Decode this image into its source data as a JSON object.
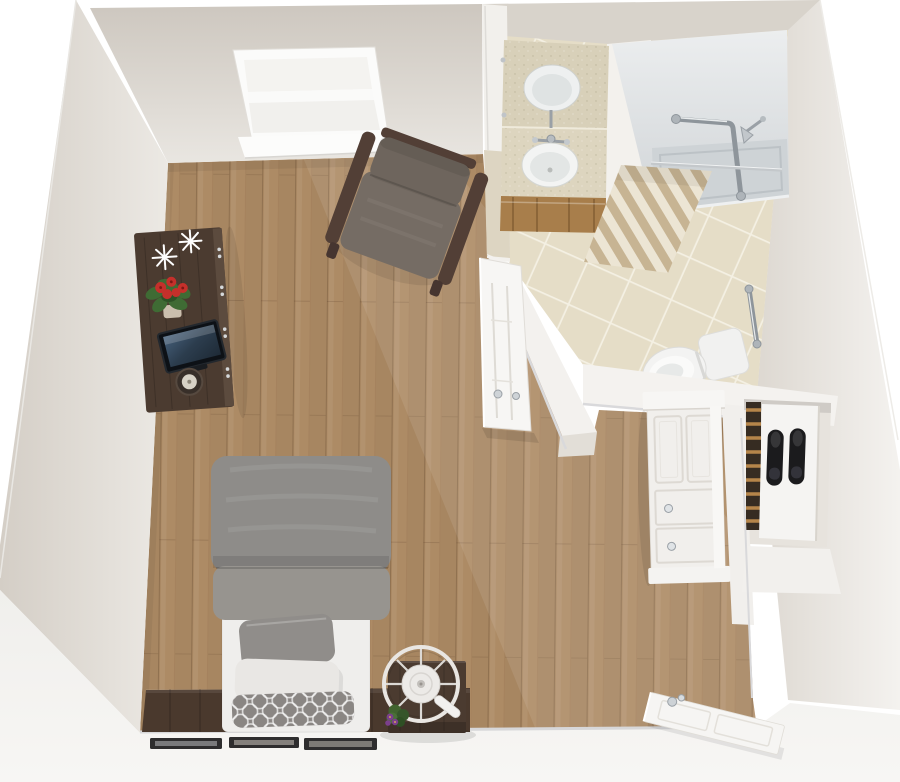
{
  "meta": {
    "title": "Studio apartment with accessible bathroom - top-down 3D floor plan render",
    "view": "top-down dollhouse 3D render",
    "canvas_width": 900,
    "canvas_height": 782
  },
  "colors": {
    "background": "#ffffff",
    "wall_top": "#f4f2ef",
    "wall_face": "#d9d4cc",
    "baseboard": "#d7d7d9",
    "floor_wood": "#ad8b65",
    "bath_tile": "#e5ddc7",
    "vanity_counter": "#d8d0b9",
    "cabinet_wood": "#a87e4b",
    "dark_wood": "#4b3b30",
    "headboard_wood": "#4a392d",
    "duvet": "#8e8c89",
    "pillow_gray": "#908d8a",
    "pillow_white": "#e9e7e4",
    "pillow_pattern": "#8a8683",
    "chair_fabric": "#756c64",
    "chair_wood": "#523f36",
    "chrome": "#99a0a6",
    "shower_tray": "#ced3d6",
    "curtain_tan": "#c7b493",
    "curtain_cream": "#ece5d4",
    "shoe_black": "#1b1b1d",
    "white_furniture": "#f1efec",
    "flower_red": "#c5302b",
    "leaf_green": "#3f6b34",
    "violet_bloom": "#7b3f8c"
  },
  "rooms": [
    {
      "name": "main-room",
      "floor": "wood plank",
      "features": [
        "double-hung window",
        "dark media console with tv, red flowers, white decor and lamp",
        "fabric armchair with wood arms",
        "bed with gray duvet, gray pillow, white pillow, trellis pillow",
        "dark wood headboard wall panel",
        "three wall picture frames",
        "nightstand with round fan and african violet",
        "white paneled dresser"
      ]
    },
    {
      "name": "bathroom",
      "floor": "beige ceramic tile",
      "features": [
        "vanity with oval sink, mirror reflection and wood cabinet",
        "walk-in shower with L grab bar, shower head and striped curtain",
        "toilet with tank",
        "vertical chrome grab bar",
        "open paneled bathroom door"
      ]
    },
    {
      "name": "closet-nook",
      "features": [
        "wooden shoe rack rails",
        "white shelf unit",
        "pair of black shoes"
      ]
    },
    {
      "name": "entry",
      "features": [
        "open white entry door with chrome knob"
      ]
    }
  ],
  "furniture": [
    "window",
    "media-console",
    "tv",
    "flower-pot",
    "snowflake-decor",
    "table-lamp",
    "armchair",
    "bed",
    "duvet",
    "gray-pillow",
    "white-pillow",
    "trellis-pillow",
    "nightstand",
    "fan",
    "african-violet",
    "picture-frames",
    "vanity",
    "sink",
    "mirror-reflection",
    "faucet",
    "shower",
    "grab-bar",
    "shower-head",
    "shower-curtain",
    "curtain-rod",
    "toilet",
    "bathroom-door",
    "white-dresser",
    "shoe-rack",
    "shoes",
    "entry-door"
  ]
}
